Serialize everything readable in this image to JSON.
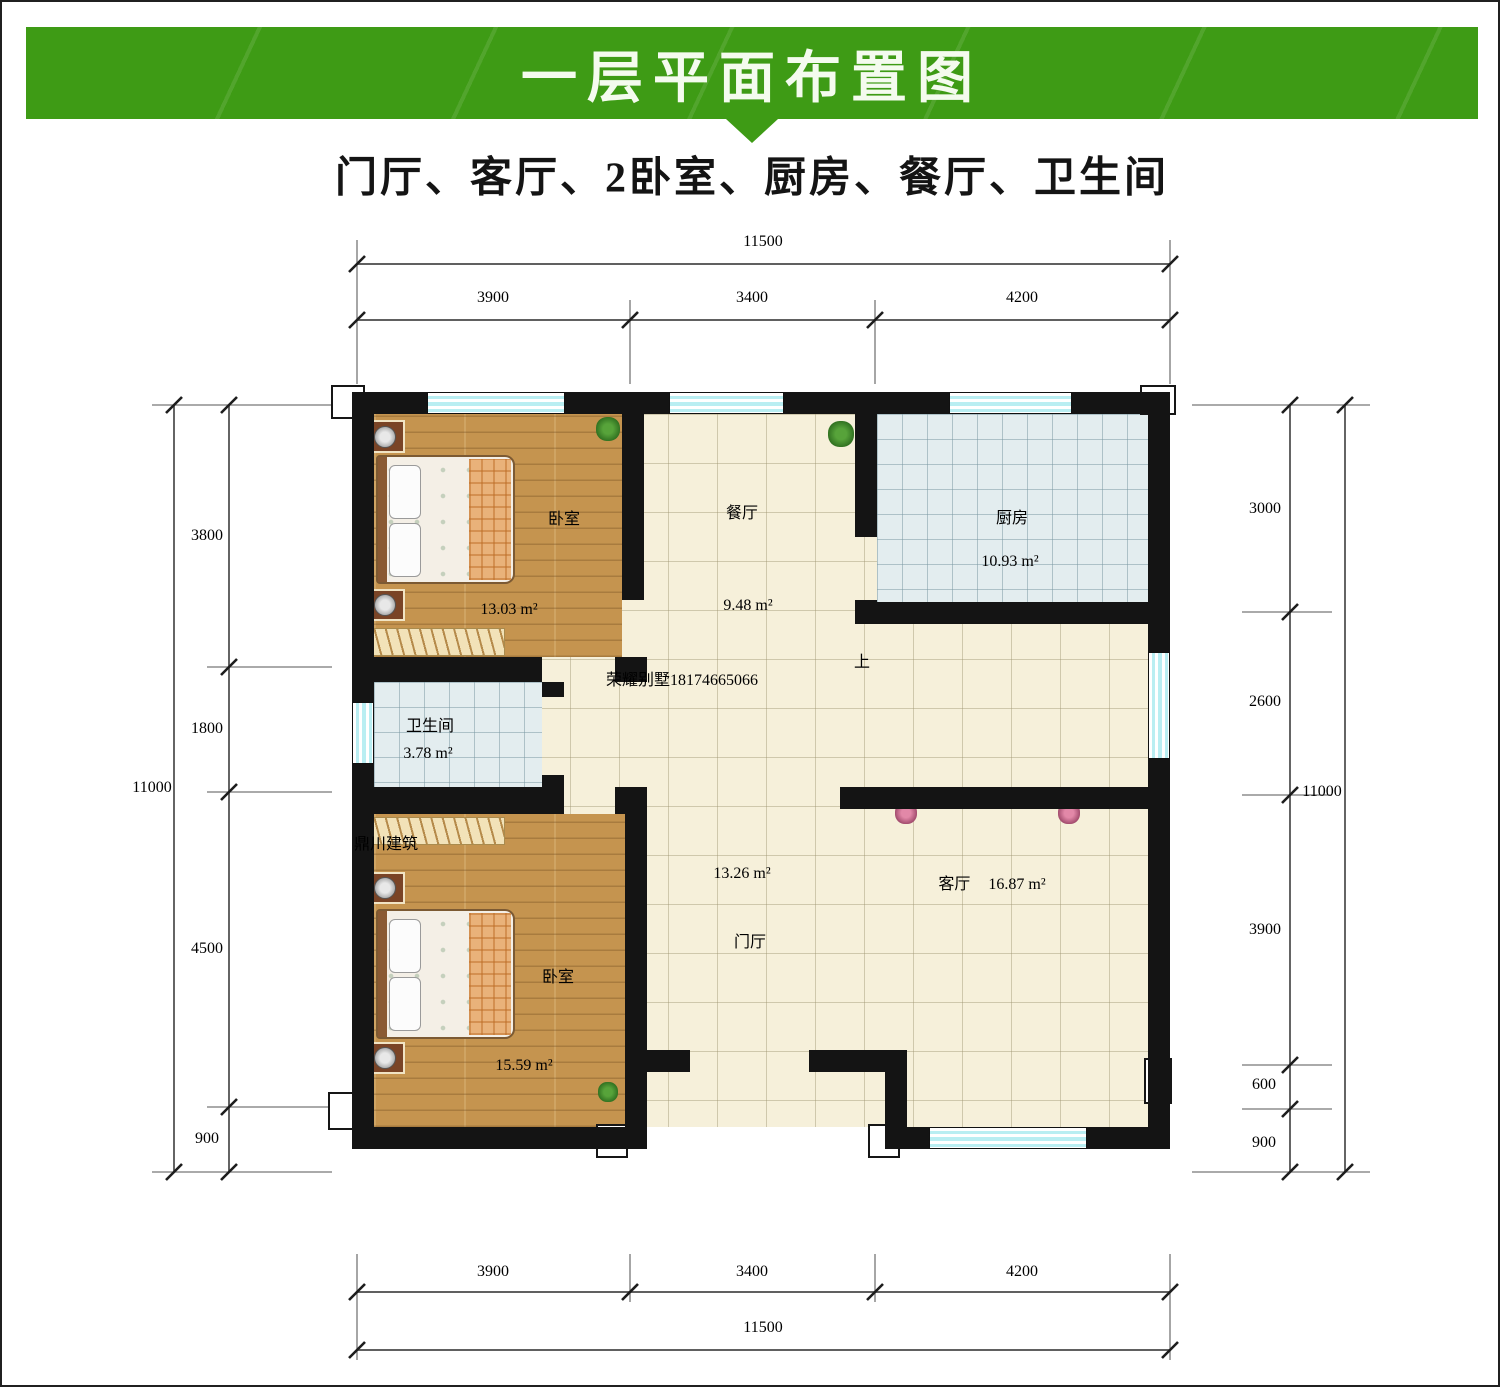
{
  "header": {
    "title": "一层平面布置图",
    "accent_color": "#3e9b15"
  },
  "subtitle": "门厅、客厅、2卧室、厨房、餐厅、卫生间",
  "watermark": {
    "main": "荣耀别墅18174665066",
    "faint": "鼎川建筑"
  },
  "rooms": {
    "bedroom_top": {
      "name": "卧室",
      "area": "13.03 m²"
    },
    "dining": {
      "name": "餐厅",
      "area": "9.48 m²"
    },
    "kitchen": {
      "name": "厨房",
      "area": "10.93 m²"
    },
    "bathroom": {
      "name": "卫生间",
      "area": "3.78 m²"
    },
    "bedroom_bottom": {
      "name": "卧室",
      "area": "15.59 m²"
    },
    "foyer": {
      "name": "门厅",
      "area": "13.26 m²"
    },
    "living": {
      "name": "客厅",
      "area": "16.87 m²"
    }
  },
  "stairs": {
    "label": "上"
  },
  "dimensions": {
    "top": {
      "overall": "11500",
      "segments": [
        "3900",
        "3400",
        "4200"
      ]
    },
    "bottom": {
      "overall": "11500",
      "segments": [
        "3900",
        "3400",
        "4200"
      ]
    },
    "left": {
      "overall": "11000",
      "segments": [
        "3800",
        "1800",
        "4500",
        "900"
      ]
    },
    "right": {
      "overall": "11000",
      "segments": [
        "3000",
        "2600",
        "3900",
        "600",
        "900"
      ]
    }
  }
}
